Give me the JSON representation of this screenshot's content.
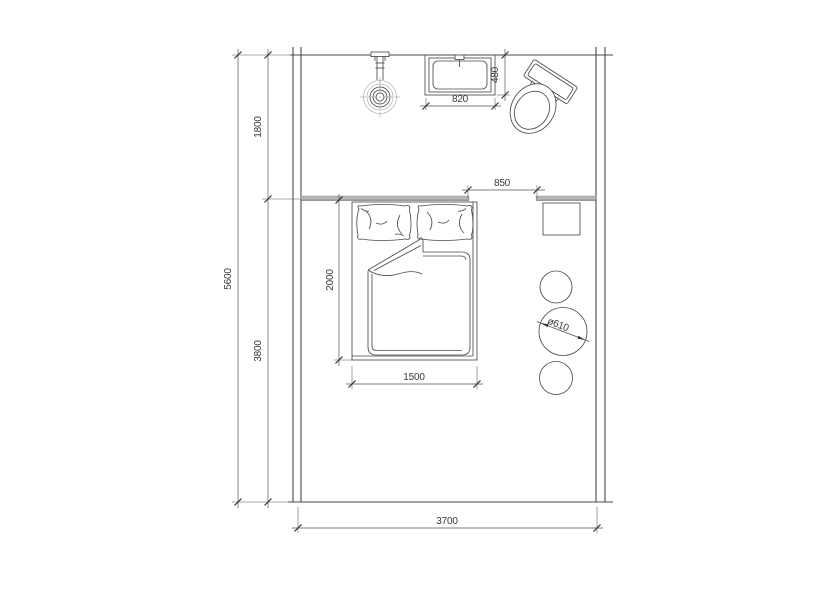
{
  "drawing": {
    "kind": "floor-plan"
  },
  "colors": {
    "background": "#ffffff",
    "line": "#4a4a4a",
    "dim_line": "#555555",
    "text": "#383838",
    "partition": "#b5b5b5"
  },
  "dimensions": {
    "total_depth": "5600",
    "bath_zone_depth": "1800",
    "sleep_zone_depth": "3800",
    "room_width": "3700",
    "bed_length": "2000",
    "bed_width": "1500",
    "opening_width": "850",
    "basin_width": "820",
    "basin_depth": "480",
    "table_diameter": "ø610"
  },
  "objects": {
    "shower": "shower-head",
    "basin": "wash-basin",
    "toilet": "toilet",
    "bed": "double-bed",
    "pillows": "pillows",
    "duvet": "duvet",
    "nightstand": "bedside-table",
    "round_tables": "round-stools",
    "partition": "partition-wall"
  }
}
